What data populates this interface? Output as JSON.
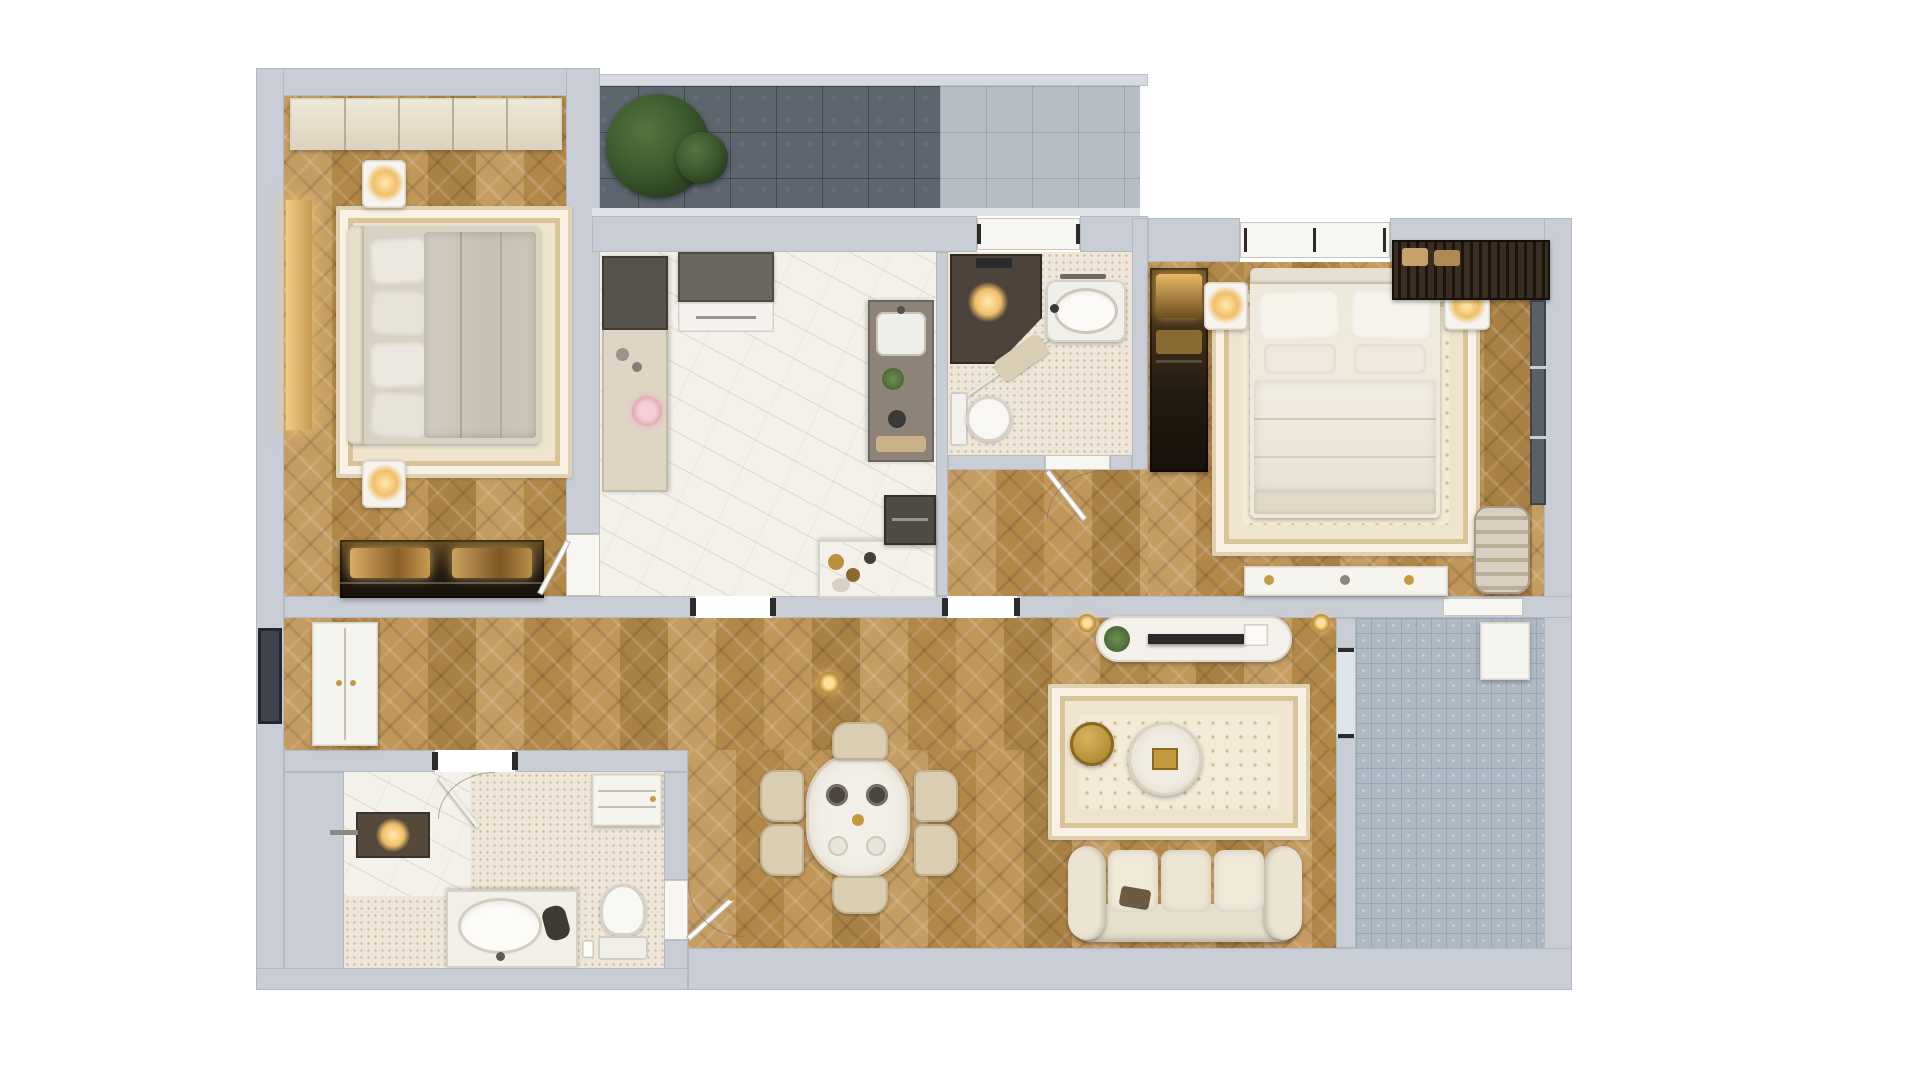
{
  "scene": {
    "kind": "photoreal-3d-apartment-floor-plan-top-view",
    "canvas": {
      "width": 1920,
      "height": 1080
    },
    "background": "#ffffff",
    "visible_text": "none"
  },
  "palette": {
    "wall_gray": "#c9cdd5",
    "wood_floor": "#bd9355",
    "marble_floor": "#f3f1ea",
    "mosaic_floor": "#eee6d6",
    "balcony_dark_tile": "#5d656f",
    "balcony_light_tile": "#b7bdc5",
    "balcony_blue_tile": "#afb9c3",
    "rug_cream": "#f3ead8",
    "bedding_gray": "#cfc9bd",
    "bedding_cream": "#f2ede2",
    "accent_gold": "#c49a3f",
    "frame_black": "#2b2b2b"
  },
  "rooms": [
    {
      "id": "bedroom-1",
      "type": "bedroom",
      "floor": "wood-herringbone",
      "furniture": [
        "built-in-closet",
        "double-bed-gray-duvet",
        "ornate-area-rug",
        "nightstand-with-lamp-top",
        "nightstand-with-lamp-bottom",
        "lit-display-wardrobe",
        "wall-vanity-strip"
      ]
    },
    {
      "id": "kitchen",
      "type": "kitchen",
      "floor": "marble",
      "furniture": [
        "left-counter-run",
        "island-appliance-block",
        "right-counter-with-sink",
        "coffee-counter",
        "flower-bouquet",
        "dark-appliance"
      ]
    },
    {
      "id": "bathroom-1",
      "type": "bathroom",
      "floor": "mosaic-tile",
      "furniture": [
        "dark-walk-in-shower",
        "oval-sink",
        "toilet",
        "bath-mat",
        "glass-partition"
      ]
    },
    {
      "id": "bedroom-2",
      "type": "bedroom",
      "floor": "wood-herringbone",
      "furniture": [
        "dark-wardrobe",
        "double-bed-cream",
        "ornate-area-rug",
        "nightstand-with-lamp-left",
        "nightstand-with-lamp-right",
        "louvered-shelf-unit",
        "corner-chair",
        "vanity-console",
        "side-window"
      ]
    },
    {
      "id": "hall-dining-living",
      "type": "living-space",
      "floor": "wood-herringbone",
      "furniture": [
        "corridor-window",
        "corridor-cabinet",
        "dining-table-oval",
        "dining-chairs-x6",
        "pendant-lamp",
        "tv-console",
        "tv-panel",
        "console-plant",
        "pendant-lamps-pair",
        "ornate-living-rug",
        "round-coffee-table-gold",
        "round-coffee-table-white",
        "three-seat-sofa"
      ]
    },
    {
      "id": "bathroom-2",
      "type": "bathroom",
      "floor": "mosaic-tile",
      "furniture": [
        "marble-shower-zone",
        "shower-glass-door",
        "shower-panel",
        "linen-cabinet",
        "vanity-oval-basin",
        "toilet",
        "waste-bin"
      ]
    },
    {
      "id": "entry-hall",
      "type": "entry",
      "floor": "wood-herringbone",
      "furniture": [
        "entry-door"
      ]
    },
    {
      "id": "balcony-top",
      "type": "balcony",
      "floor": "dark-and-light-tile",
      "furniture": [
        "large-green-plant"
      ]
    },
    {
      "id": "balcony-right",
      "type": "balcony",
      "floor": "blue-mosaic-tile",
      "furniture": [
        "white-storage-cabinet",
        "glass-sliding-door"
      ]
    }
  ]
}
